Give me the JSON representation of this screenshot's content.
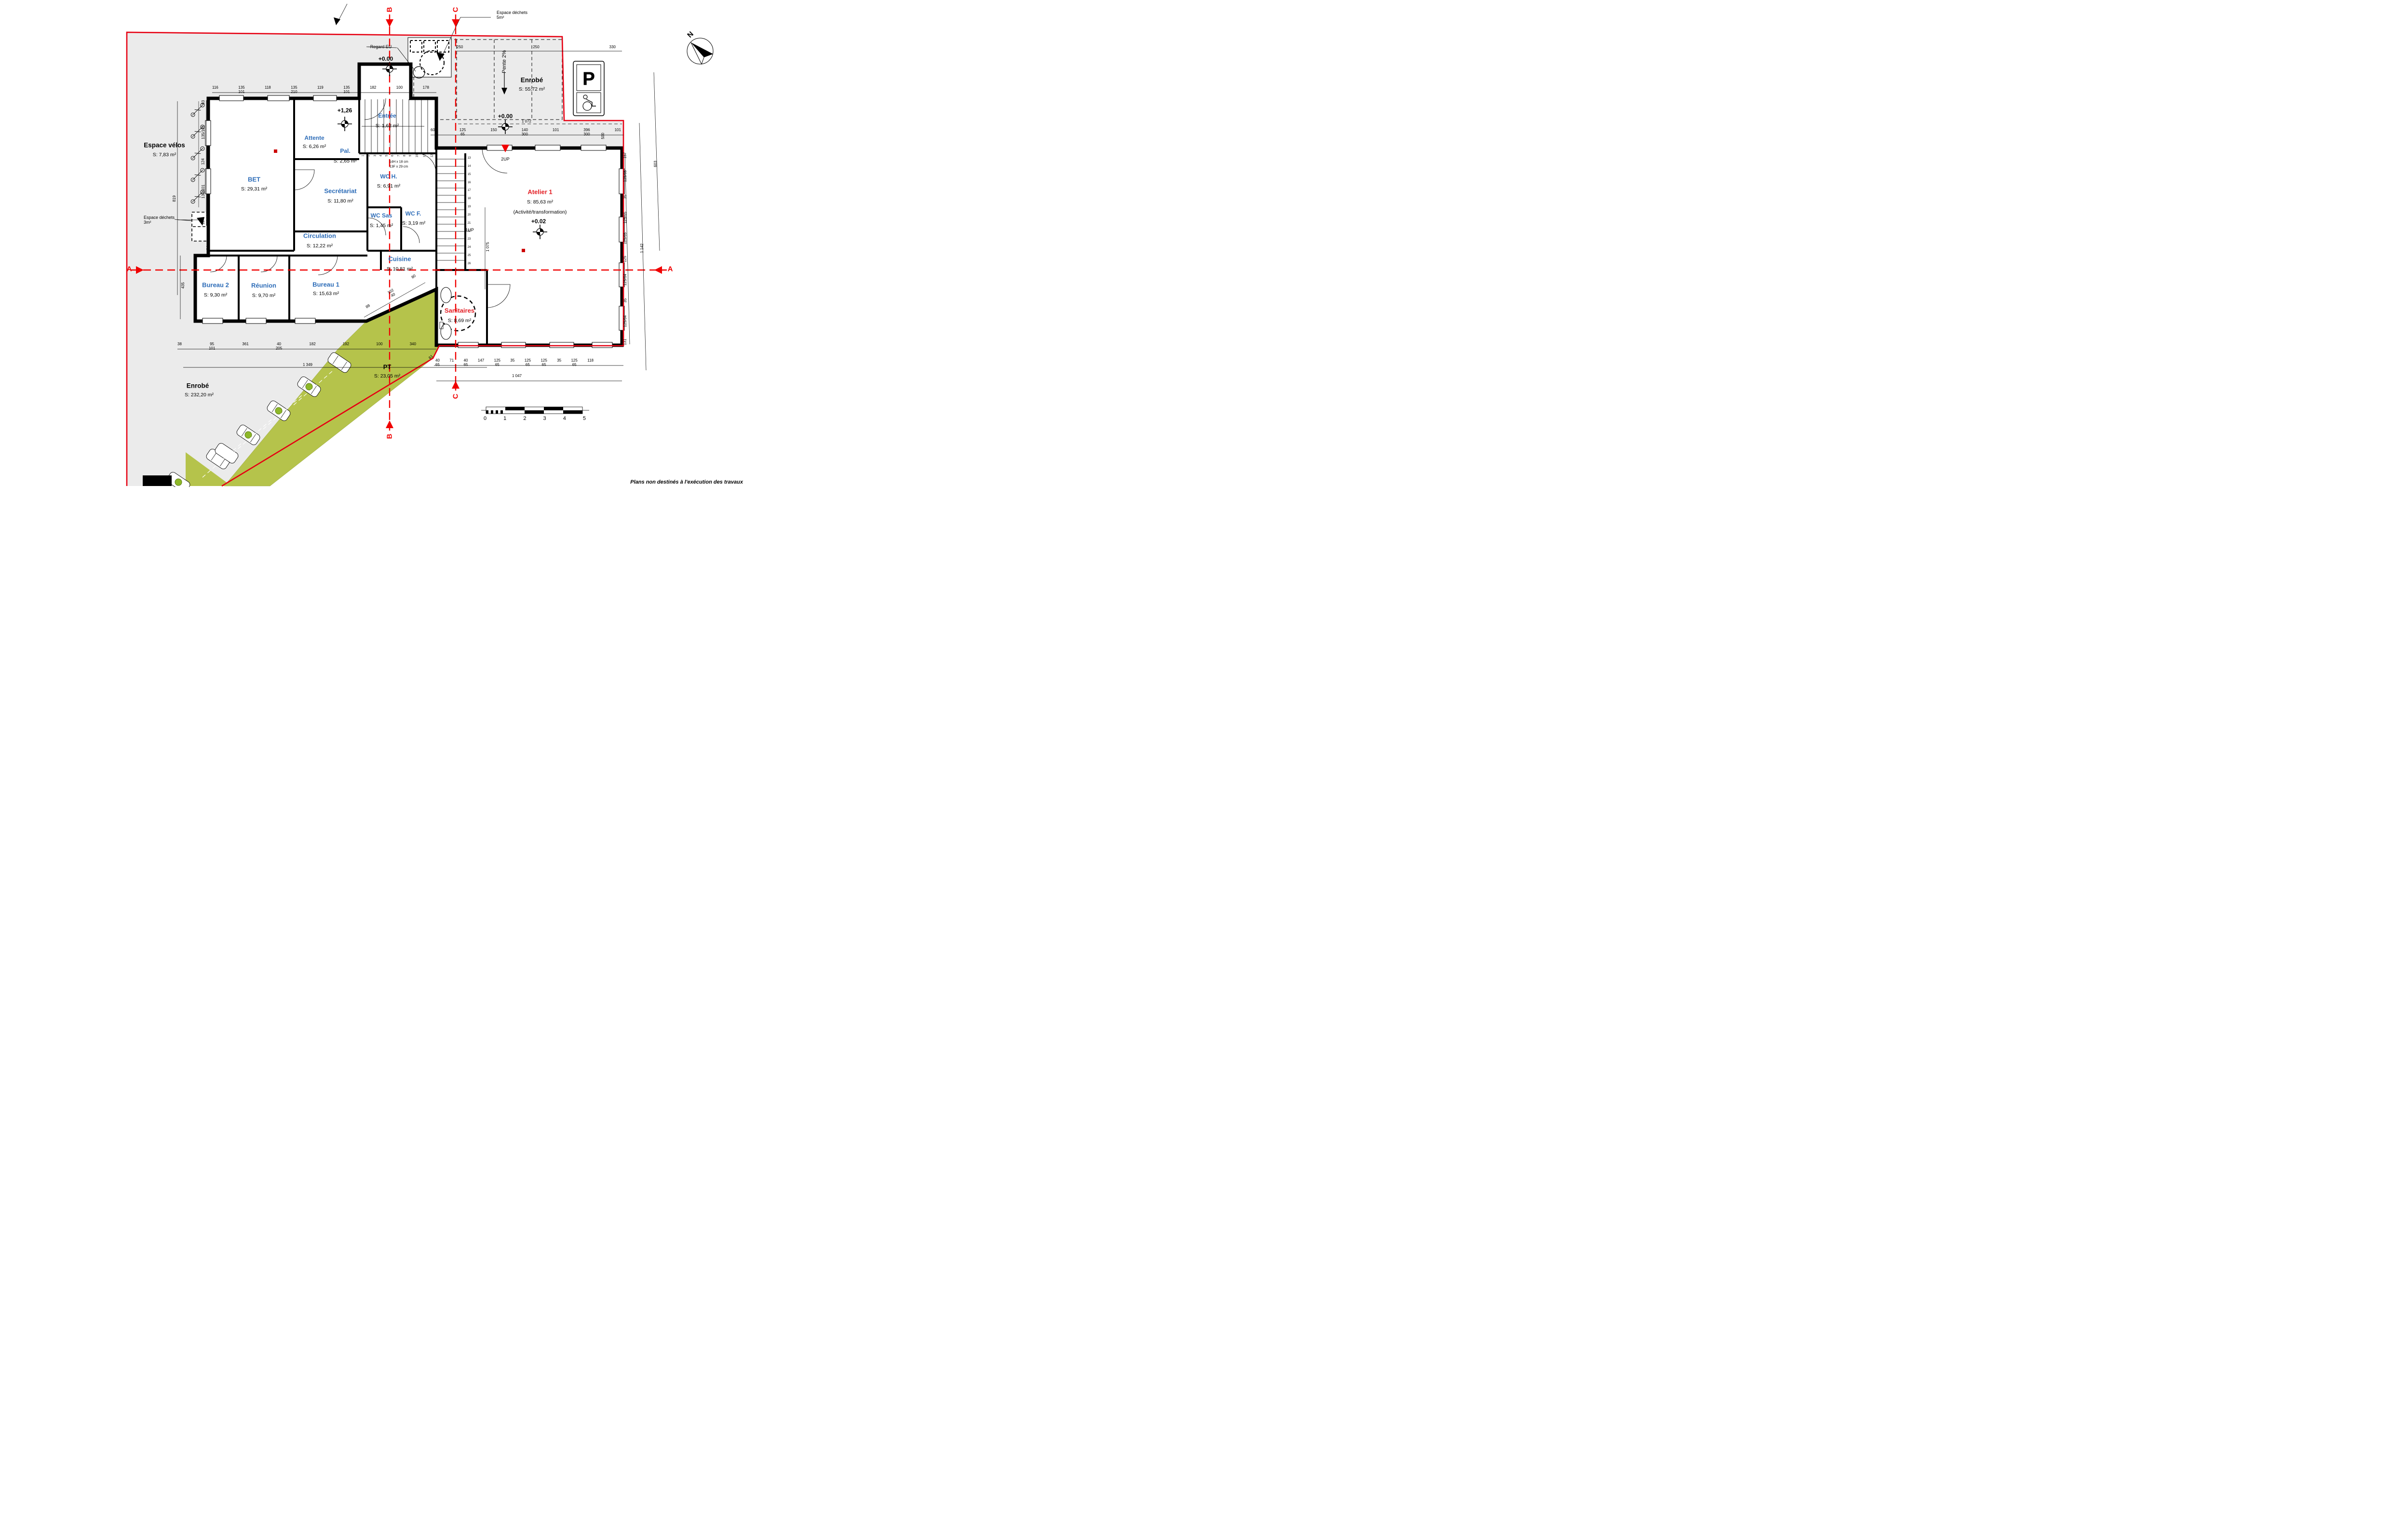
{
  "footer_note": "Plans non destinés à l'exécution des travaux",
  "north_label": "N",
  "colors": {
    "room_label_blue": "#2e6db8",
    "highlight_red": "#e31e24",
    "section_red": "#f00000",
    "boundary_red": "#e60012",
    "site_gray": "#ebebeb",
    "pt_green": "#b5c34b"
  },
  "sections": {
    "a": "A",
    "b": "B",
    "c": "C"
  },
  "rooms": {
    "attente": {
      "name": "Attente",
      "area": "S: 6,26 m²"
    },
    "pal": {
      "name": "Pal.",
      "area": "S: 2,65 m²"
    },
    "entree": {
      "name": "Entrée",
      "area": "S: 1,62 m²"
    },
    "bet": {
      "name": "BET",
      "area": "S: 29,31 m²"
    },
    "secretariat": {
      "name": "Secrétariat",
      "area": "S: 11,80 m²"
    },
    "wch": {
      "name": "WC H.",
      "area": "S: 6,91 m²"
    },
    "wcsas": {
      "name": "WC Sas",
      "area": "S: 1,45 m²"
    },
    "wcf": {
      "name": "WC F.",
      "area": "S: 3,19 m²"
    },
    "circulation": {
      "name": "Circulation",
      "area": "S: 12,22 m²"
    },
    "cuisine": {
      "name": "Cuisine",
      "area": "S: 10,81 m²"
    },
    "bureau1": {
      "name": "Bureau 1",
      "area": "S: 15,63 m²"
    },
    "bureau2": {
      "name": "Bureau 2",
      "area": "S: 9,30 m²"
    },
    "reunion": {
      "name": "Réunion",
      "area": "S: 9,70 m²"
    },
    "atelier": {
      "name": "Atelier 1",
      "area": "S: 85,63 m²",
      "sub": "(Activité/transformation)"
    },
    "sanitaires": {
      "name": "Sanitaires",
      "area": "S: 8,69 m²"
    },
    "pt": {
      "name": "PT",
      "area": "S: 23,05 m²"
    }
  },
  "site": {
    "velos": {
      "name": "Espace vélos",
      "area": "S: 7,83 m²"
    },
    "enrobe1": {
      "name": "Enrobé",
      "area": "S: 55,72 m²"
    },
    "enrobe2": {
      "name": "Enrobé",
      "area": "S: 232,20 m²"
    },
    "dechets5": "Espace déchets\n5m²",
    "dechets3": "Espace déchets\n3m²",
    "regard_eu": "Regard EU",
    "pente": "Pente 2%",
    "parking_sign": "P"
  },
  "levels": {
    "top": "+0.00",
    "parking": "+0.00",
    "palier": "+1,26",
    "atelier": "+0.02"
  },
  "stairs": {
    "note1": "14H x 18 cm",
    "note2": "13F x 29 cm",
    "up1": "1UP",
    "up2": "2UP",
    "flight1": [
      "1",
      "2",
      "3",
      "4",
      "5",
      "6",
      "7",
      "8",
      "9",
      "10",
      "11",
      "12"
    ],
    "flight2": [
      "13",
      "14",
      "15",
      "16",
      "17",
      "18",
      "19",
      "20",
      "21",
      "22",
      "23",
      "24",
      "25",
      "26"
    ]
  },
  "scalebar": [
    "0",
    "1",
    "2",
    "3",
    "4",
    "5"
  ],
  "dims": {
    "top": [
      "116",
      "135\n101",
      "118",
      "135\n210",
      "119",
      "135\n101",
      "182",
      "100",
      "178"
    ],
    "parking": [
      "250",
      "250",
      "330"
    ],
    "mid": [
      "60",
      "125\n65",
      "150",
      "140\n300",
      "101",
      "396\n300",
      "101"
    ],
    "mid_total": "1 072",
    "bottom_left": [
      "38",
      "95\n101",
      "361",
      "40\n205",
      "182",
      "192",
      "100",
      "340"
    ],
    "bottom_left_total": "1 349",
    "bottom_right": [
      "40\n65",
      "71",
      "40\n65",
      "147",
      "125\n65",
      "35",
      "125\n65",
      "125\n65",
      "35",
      "125\n65",
      "118"
    ],
    "bottom_right_total": "1 047",
    "d61": "61",
    "right": [
      "157",
      "125/65",
      "35",
      "125/65",
      "125/65",
      "125",
      "125/64",
      "35",
      "125/64",
      "131"
    ],
    "right_total": "1 142",
    "r603": "603",
    "r500": "500",
    "r1075": "1 075",
    "left": [
      "83",
      "135/101",
      "124",
      "135/101",
      "124"
    ],
    "left2": [
      "135/101",
      "84"
    ],
    "left_total": "819",
    "left_total2": "435",
    "diag": [
      "88",
      "102\n40",
      "80"
    ]
  }
}
